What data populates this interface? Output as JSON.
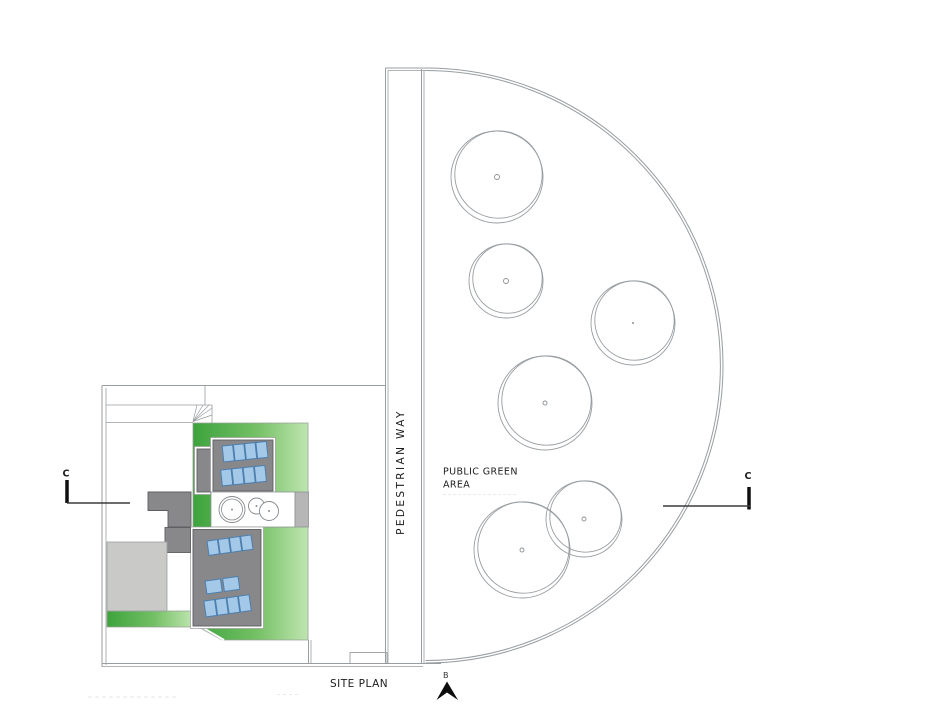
{
  "drawing": {
    "title": "SITE PLAN",
    "public_area_label": {
      "line1": "PUBLIC GREEN",
      "line2": "AREA"
    },
    "pedestrian_label": "PEDESTRIAN WAY",
    "section_markers": {
      "left": "C",
      "right": "C",
      "bottom": "B"
    }
  },
  "colors": {
    "line": "#989da1",
    "line_dark": "#3b3b3b",
    "marker_black": "#101010",
    "text": "#1c1c1c",
    "green_dark": "#3da33d",
    "green_mid": "#74c065",
    "green_light": "#bfe5b0",
    "roof_gray": "#88888b",
    "block_gray": "#b5b6b5",
    "light_gray": "#c9c9c8",
    "panel_fill": "#a3c8e8",
    "panel_edge": "#4c7fae"
  },
  "public_green": {
    "trees": [
      {
        "cx": 497,
        "cy": 177,
        "r": 46,
        "dot": 2.5
      },
      {
        "cx": 506,
        "cy": 281,
        "r": 37,
        "dot": 2.5
      },
      {
        "cx": 633,
        "cy": 323,
        "r": 42,
        "dot": 1
      },
      {
        "cx": 545,
        "cy": 403,
        "r": 47,
        "dot": 2
      },
      {
        "cx": 522,
        "cy": 550,
        "r": 48,
        "dot": 2
      },
      {
        "cx": 584,
        "cy": 519,
        "r": 38,
        "dot": 2
      }
    ]
  },
  "building": {
    "courtyard_circles": [
      {
        "cx": 232,
        "cy": 509.5,
        "r": 13
      },
      {
        "cx": 256.5,
        "cy": 506,
        "r": 8
      },
      {
        "cx": 269,
        "cy": 511,
        "r": 9.5
      }
    ],
    "solar_panel_groups": [
      {
        "x": 223,
        "y": 446,
        "count": 4,
        "w": 10.5,
        "h": 16,
        "gap": 0.8,
        "angle": -6
      },
      {
        "x": 221.5,
        "y": 470,
        "count": 4,
        "w": 10.5,
        "h": 16,
        "gap": 0.8,
        "angle": -6
      },
      {
        "x": 208,
        "y": 541,
        "count": 4,
        "w": 10.5,
        "h": 14.5,
        "gap": 0.8,
        "angle": -8
      },
      {
        "x": 206,
        "y": 581,
        "count": 2,
        "w": 15.5,
        "h": 13,
        "gap": 2.2,
        "angle": -8
      },
      {
        "x": 205,
        "y": 601,
        "count": 4,
        "w": 10.8,
        "h": 16,
        "gap": 0.8,
        "angle": -8
      }
    ]
  }
}
